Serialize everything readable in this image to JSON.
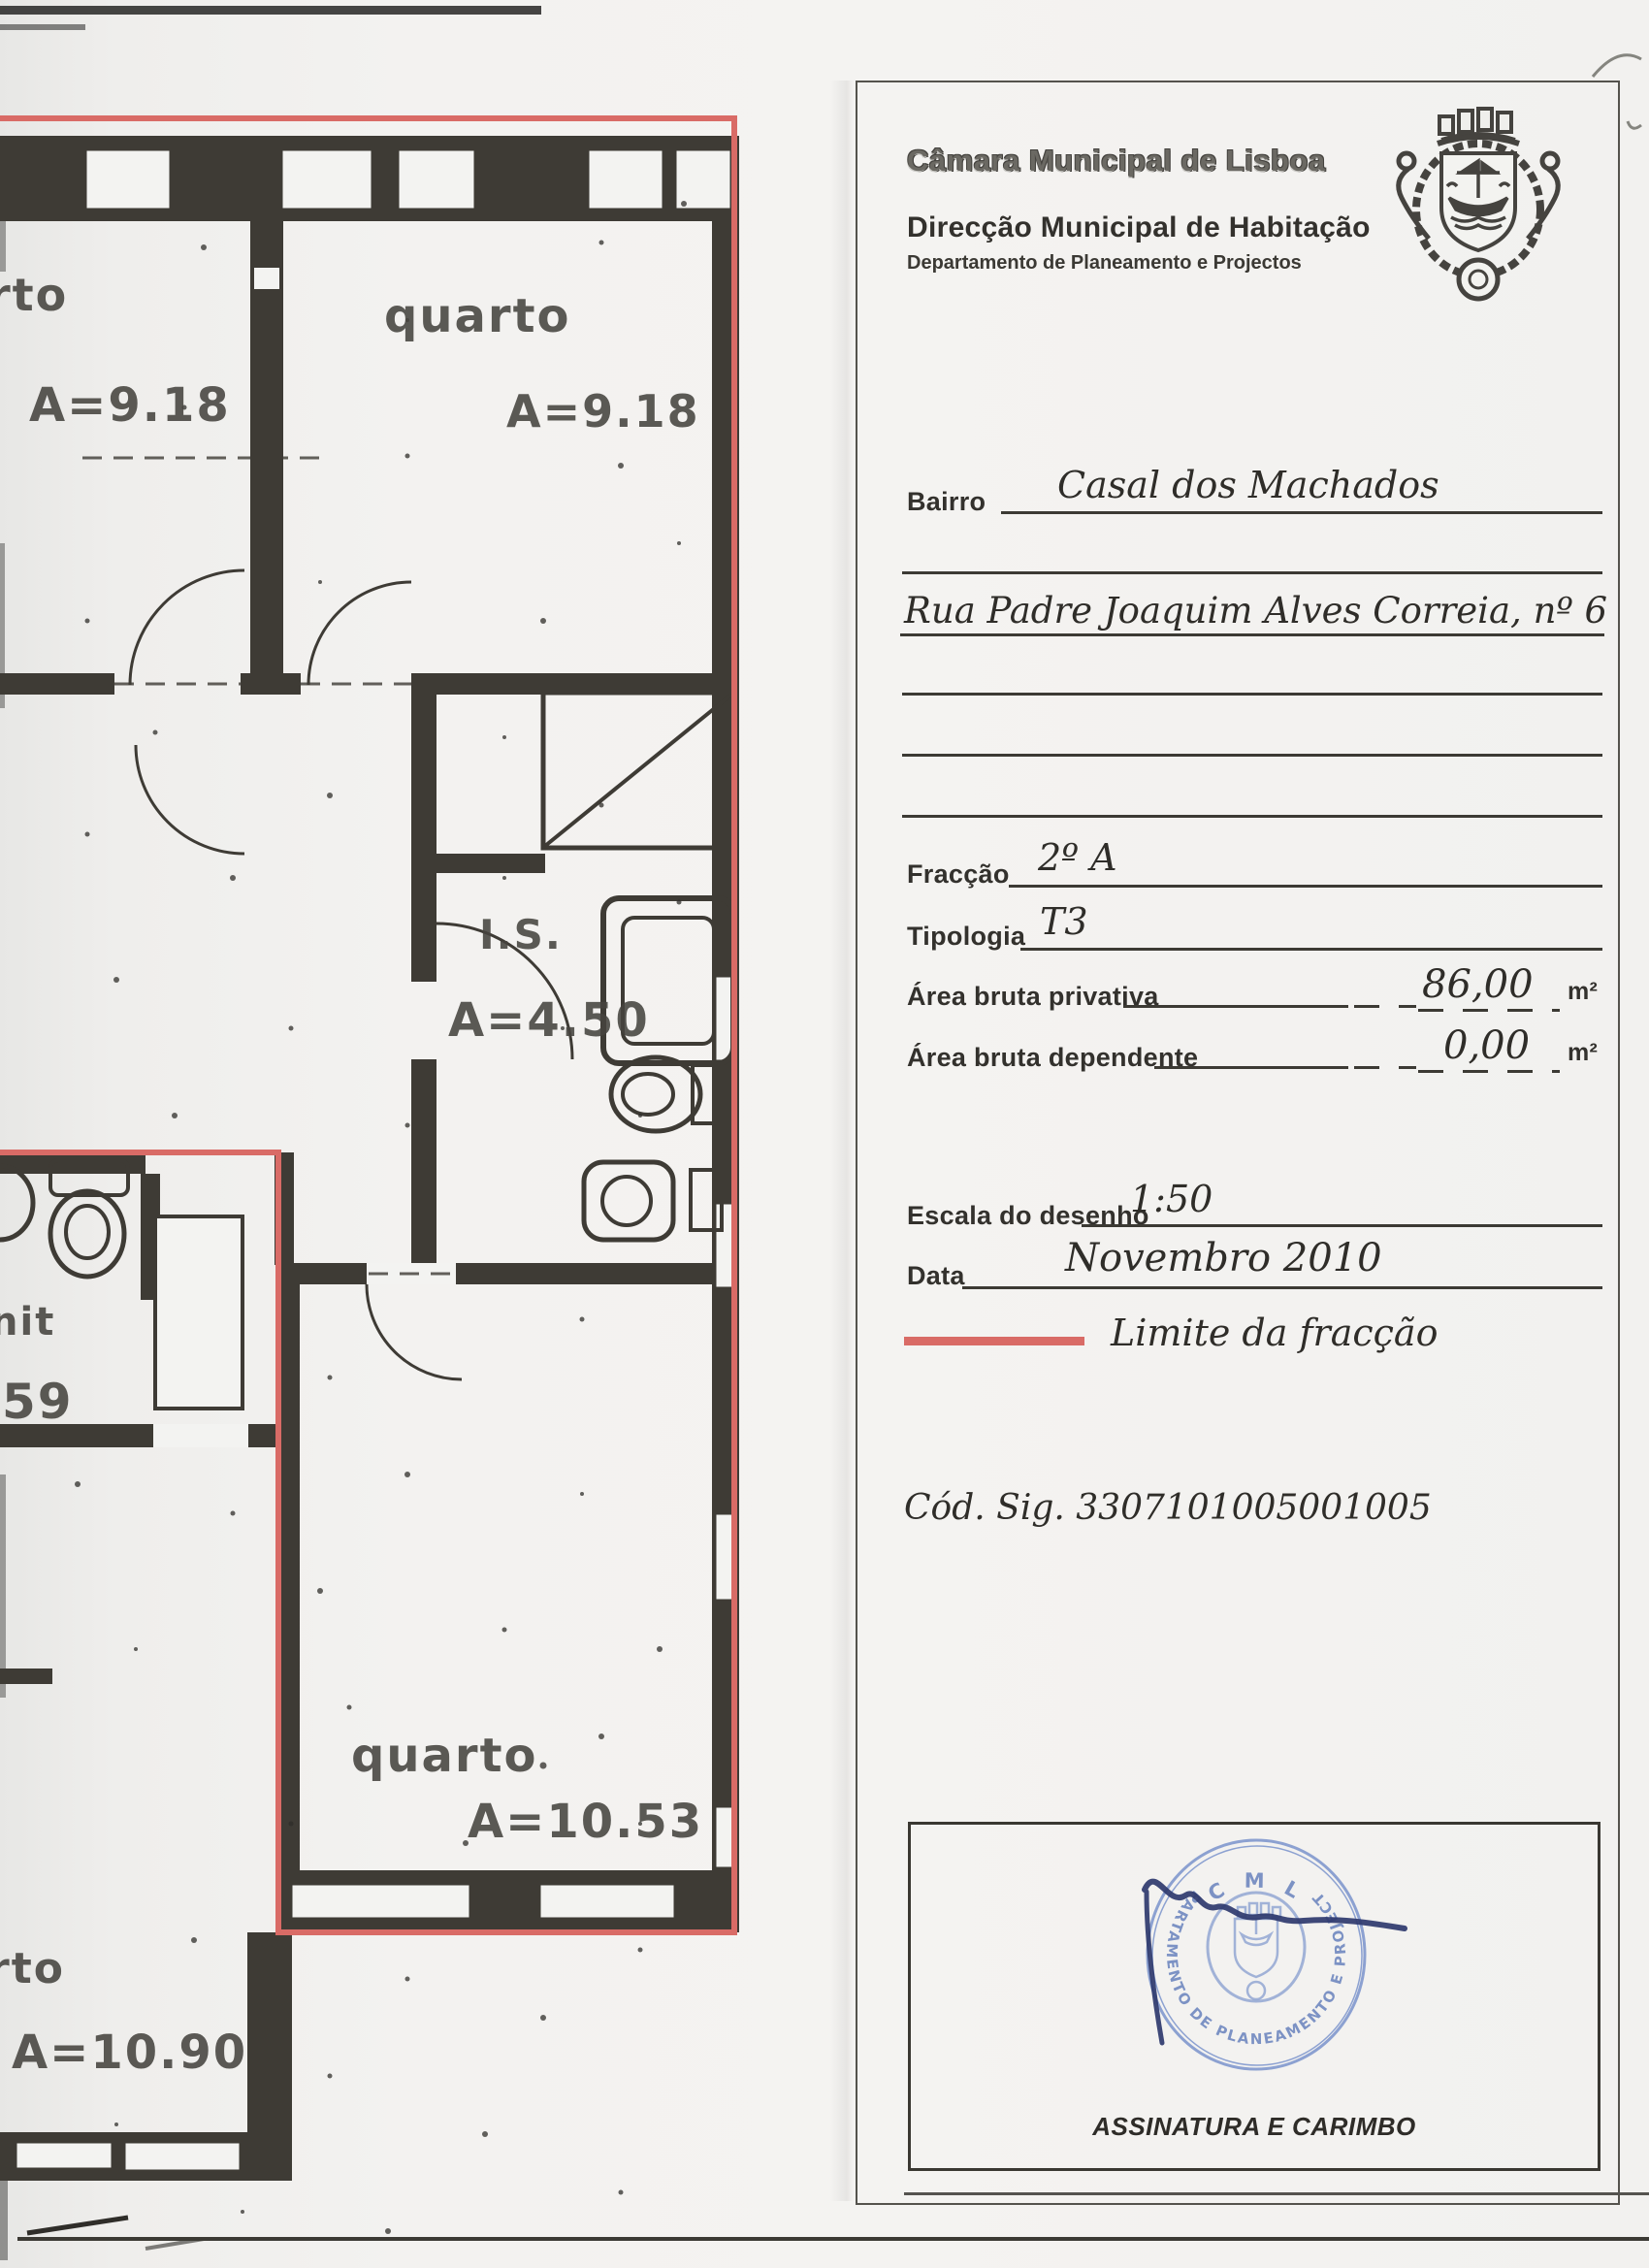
{
  "header": {
    "org": "Câmara Municipal de Lisboa",
    "dept": "Direcção Municipal de Habitação",
    "subdept": "Departamento de Planeamento e Projectos"
  },
  "form": {
    "bairro": {
      "label": "Bairro",
      "value": "Casal dos Machados"
    },
    "address": {
      "value": "Rua Padre Joaquim Alves Correia, nº 6"
    },
    "fraccao": {
      "label": "Fracção",
      "value": "2º A"
    },
    "tipologia": {
      "label": "Tipologia",
      "value": "T3"
    },
    "area_privativa": {
      "label": "Área bruta privativa",
      "value": "86,00",
      "unit": "m²"
    },
    "area_dependente": {
      "label": "Área bruta dependente",
      "value": "0,00",
      "unit": "m²"
    },
    "escala": {
      "label": "Escala do desenho",
      "value": "1:50"
    },
    "data": {
      "label": "Data",
      "value": "Novembro 2010"
    },
    "legend": {
      "label": "Limite da fracção",
      "color": "#d96b66"
    },
    "cod_sig": "Cód. Sig. 3307101005001005"
  },
  "signature_box": {
    "caption": "ASSINATURA E CARIMBO",
    "stamp": {
      "top_text": "C M L",
      "ring_text": "DEPARTAMENTO DE PLANEAMENTO E PROJECTOS",
      "color": "#7088c0"
    }
  },
  "plan": {
    "legend_color": "#d96b66",
    "rooms": [
      {
        "label": "rto",
        "area": "A=9.18"
      },
      {
        "label": "quarto",
        "area": "A=9.18"
      },
      {
        "label": "I.S.",
        "area": "A=4.50"
      },
      {
        "label": "nit",
        "area": "59"
      },
      {
        "label": "quarto",
        "area": "A=10.53"
      },
      {
        "label": "rto",
        "area": "A=10.90"
      }
    ]
  }
}
